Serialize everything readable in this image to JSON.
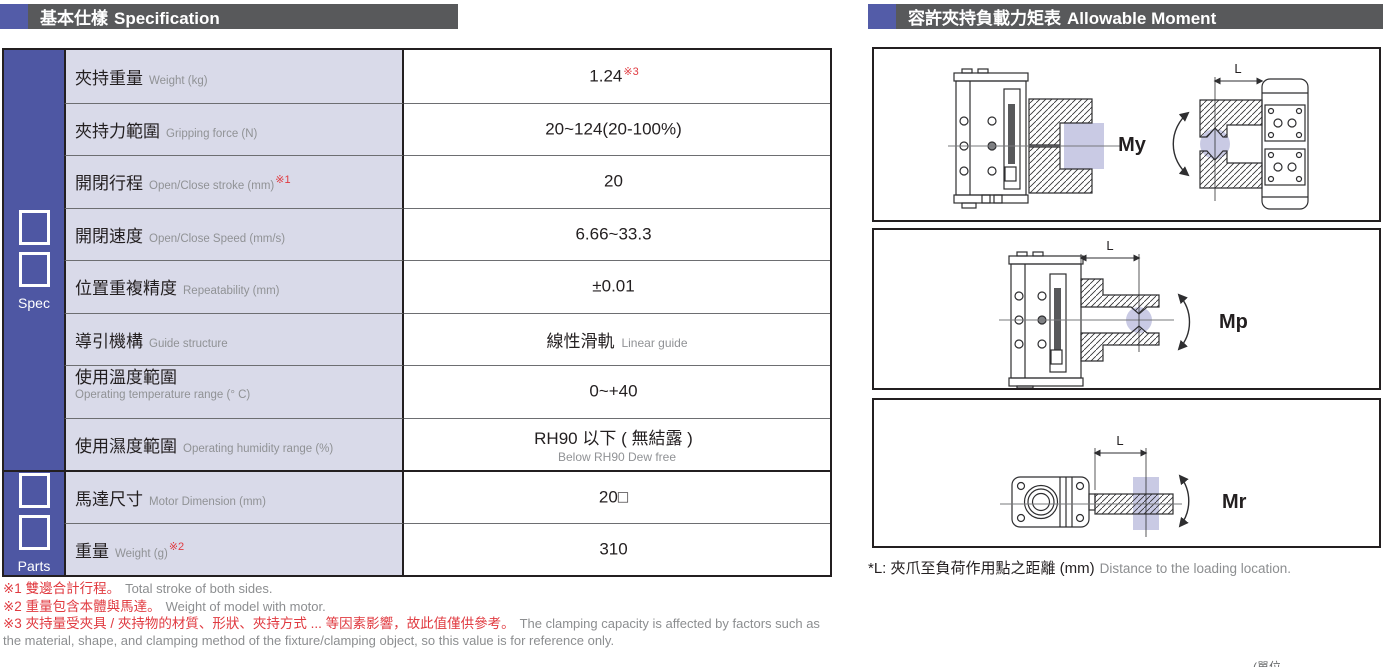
{
  "spec": {
    "header": {
      "zh": "基本仕樣",
      "en": "Specification"
    },
    "sidebar": {
      "spec": "Spec",
      "parts": "Parts"
    },
    "rows": [
      {
        "zh": "夾持重量",
        "en": "Weight (kg)",
        "val": "1.24",
        "val_sup": "※3"
      },
      {
        "zh": "夾持力範圍",
        "en": "Gripping force (N)",
        "val": "20~124(20-100%)"
      },
      {
        "zh": "開閉行程",
        "en": "Open/Close stroke (mm)",
        "sup": "※1",
        "val": "20"
      },
      {
        "zh": "開閉速度",
        "en": "Open/Close Speed (mm/s)",
        "val": "6.66~33.3"
      },
      {
        "zh": "位置重複精度",
        "en": "Repeatability (mm)",
        "val": "±0.01"
      },
      {
        "zh": "導引機構",
        "en": "Guide structure",
        "val": "線性滑軌",
        "val_en": "Linear guide"
      },
      {
        "zh": "使用溫度範圍",
        "en": "Operating temperature range (° C)",
        "val": "0~+40"
      },
      {
        "zh": "使用濕度範圍",
        "en": "Operating humidity range (%)",
        "val": "RH90 以下 ( 無結露 )",
        "val_sub": "Below RH90 Dew free"
      },
      {
        "zh": "馬達尺寸",
        "en": "Motor Dimension (mm)",
        "val": "20□"
      },
      {
        "zh": "重量",
        "en": "Weight (g)",
        "sup": "※2",
        "val": "310"
      }
    ],
    "footnotes": [
      {
        "zh": "※1 雙邊合計行程。",
        "en": "Total stroke of both sides."
      },
      {
        "zh": "※2 重量包含本體與馬達。",
        "en": "Weight of model with motor."
      },
      {
        "zh": "※3 夾持量受夾具 / 夾持物的材質、形狀、夾持方式 ... 等因素影響，故此值僅供參考。",
        "en": "The clamping capacity is affected by factors such as the material, shape, and clamping method of the fixture/clamping object, so this value is for reference only."
      }
    ]
  },
  "moment": {
    "header": {
      "zh": "容許夾持負載力矩表",
      "en": "Allowable Moment"
    },
    "panels": [
      {
        "moment": "My",
        "dim": "L"
      },
      {
        "moment": "Mp",
        "dim": "L"
      },
      {
        "moment": "Mr",
        "dim": "L"
      }
    ],
    "caption": {
      "zh": "*L: 夾爪至負荷作用點之距離 (mm)",
      "en": "Distance to the loading location."
    }
  },
  "page": {
    "unit_note": "(單位"
  },
  "colors": {
    "accent_blue": "#535CA8",
    "sidebar_blue": "#4E57A3",
    "header_gray": "#58595B",
    "label_cell_bg": "#D9DAE9",
    "note_red": "#E03A40",
    "workpiece_lavender": "#C9CAE4",
    "line_dark": "#2E2E30"
  }
}
